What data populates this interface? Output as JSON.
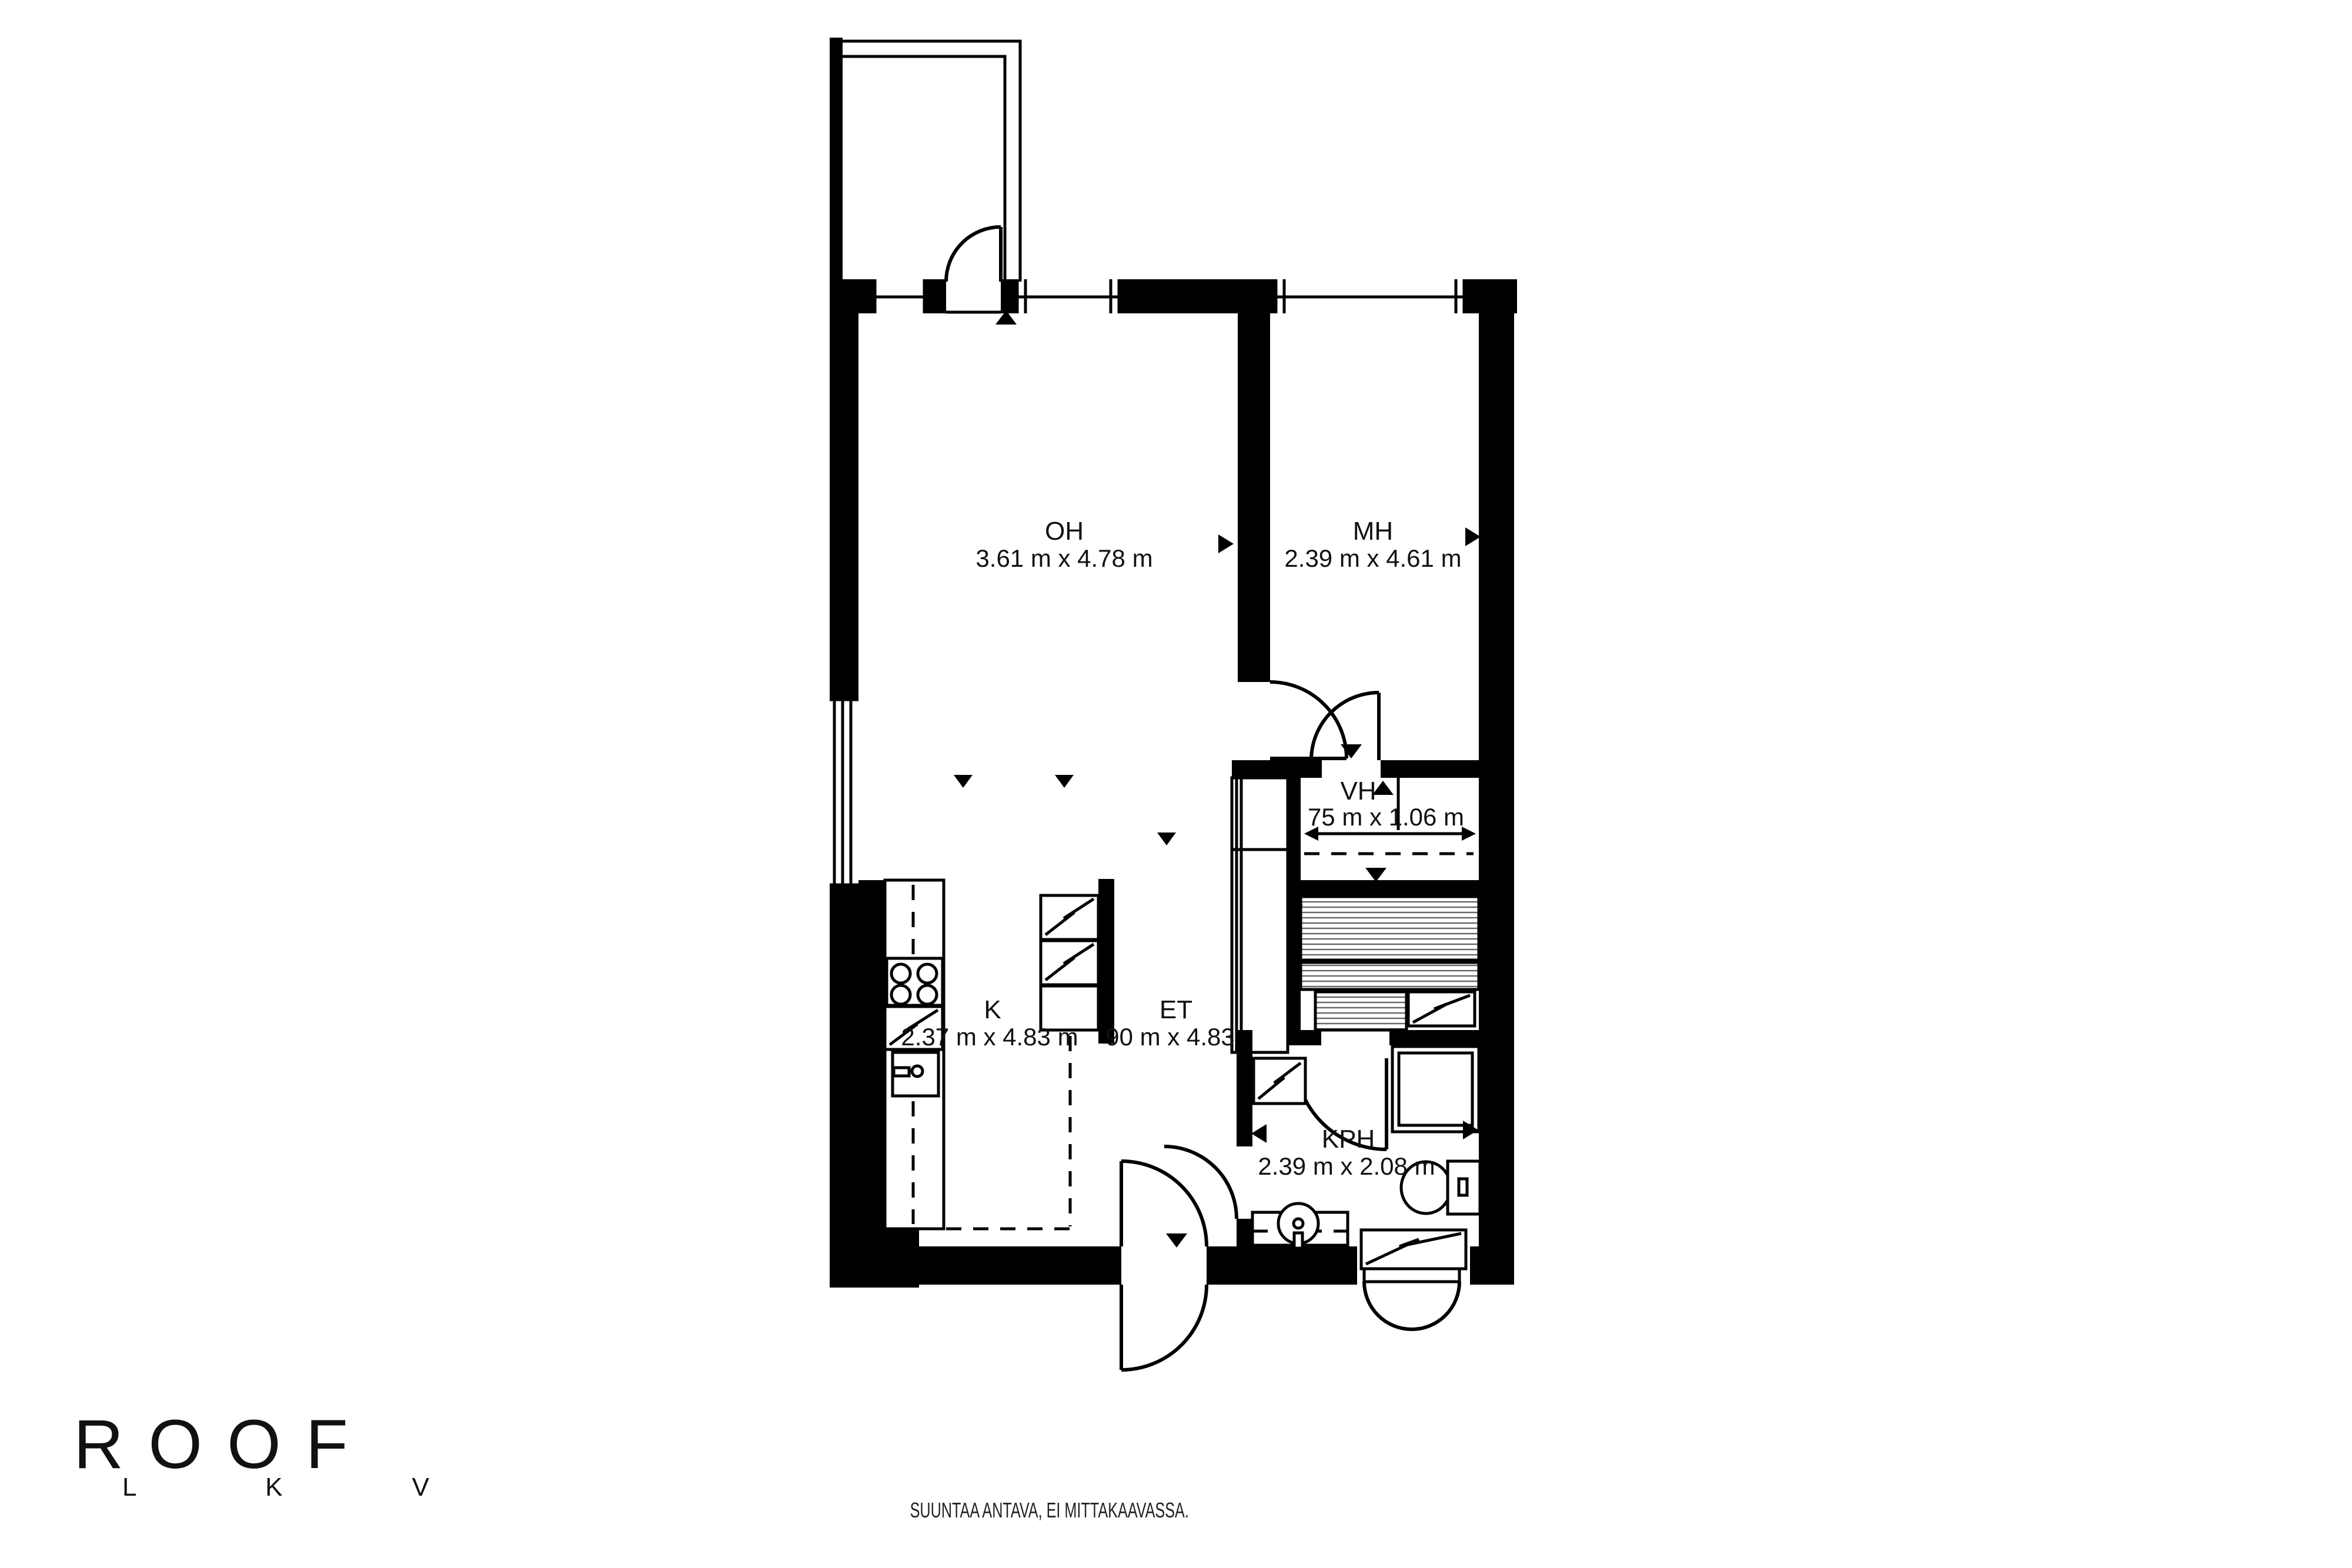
{
  "branding": {
    "logo": "ROOF",
    "logo_sub": "L K V"
  },
  "footer": {
    "disclaimer": "SUUNTAA ANTAVA, EI MITTAKAAVASSA."
  },
  "colors": {
    "wall": "#000000",
    "background": "#ffffff",
    "hatch": "#666666"
  },
  "rooms": {
    "oh": {
      "label": "OH",
      "dims": "3.61 m x 4.78 m"
    },
    "mh": {
      "label": "MH",
      "dims": "2.39 m x 4.61 m"
    },
    "vh": {
      "label": "VH",
      "dims": "75 m x 1.06 m"
    },
    "k": {
      "label": "K",
      "dims": "2.37 m x 4.83 m"
    },
    "et": {
      "label": "ET",
      "dims": "90 m x 4.83"
    },
    "kph": {
      "label": "KPH",
      "dims": "2.39 m x 2.08 m"
    }
  }
}
